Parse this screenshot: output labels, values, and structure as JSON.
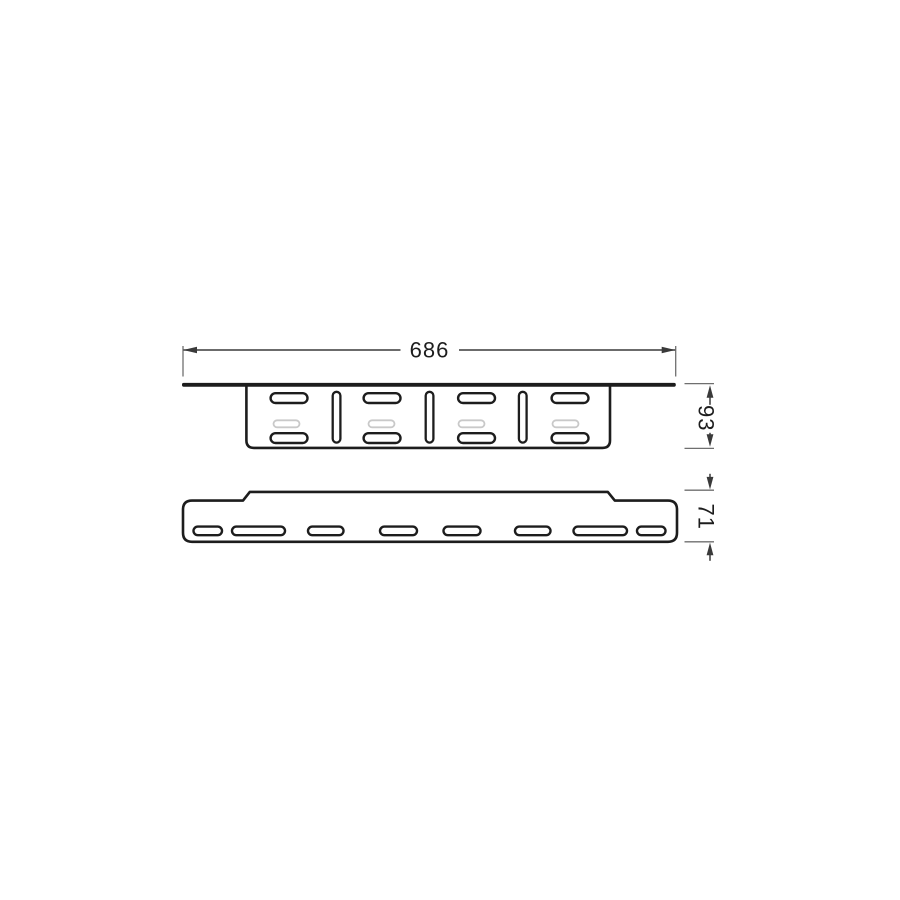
{
  "title": "mounting-bracket-technical-drawing",
  "background": "#ffffff",
  "colors": {
    "page-bg": "#ffffff",
    "outline": "#1d1d1d",
    "fill": "#ffffff",
    "dim-line": "#3a3a3a",
    "ext-line": "#6f6f6f",
    "ghost": "#c9c9c9",
    "text": "#1d1d1d"
  },
  "dimensions": [
    {
      "id": "overall-width",
      "label": "686",
      "orientation": "horizontal",
      "applies_to": "top-view"
    },
    {
      "id": "top-view-height",
      "label": "93",
      "orientation": "vertical",
      "applies_to": "top-view"
    },
    {
      "id": "bottom-view-height",
      "label": "71",
      "orientation": "vertical",
      "applies_to": "bottom-view"
    }
  ],
  "views": {
    "top": {
      "name": "bracket-profile-view",
      "horizontal_slot_pairs": 4,
      "vertical_slots": 3,
      "hidden_slots": 4
    },
    "bottom": {
      "name": "plate-face-view",
      "slots": 8
    }
  }
}
